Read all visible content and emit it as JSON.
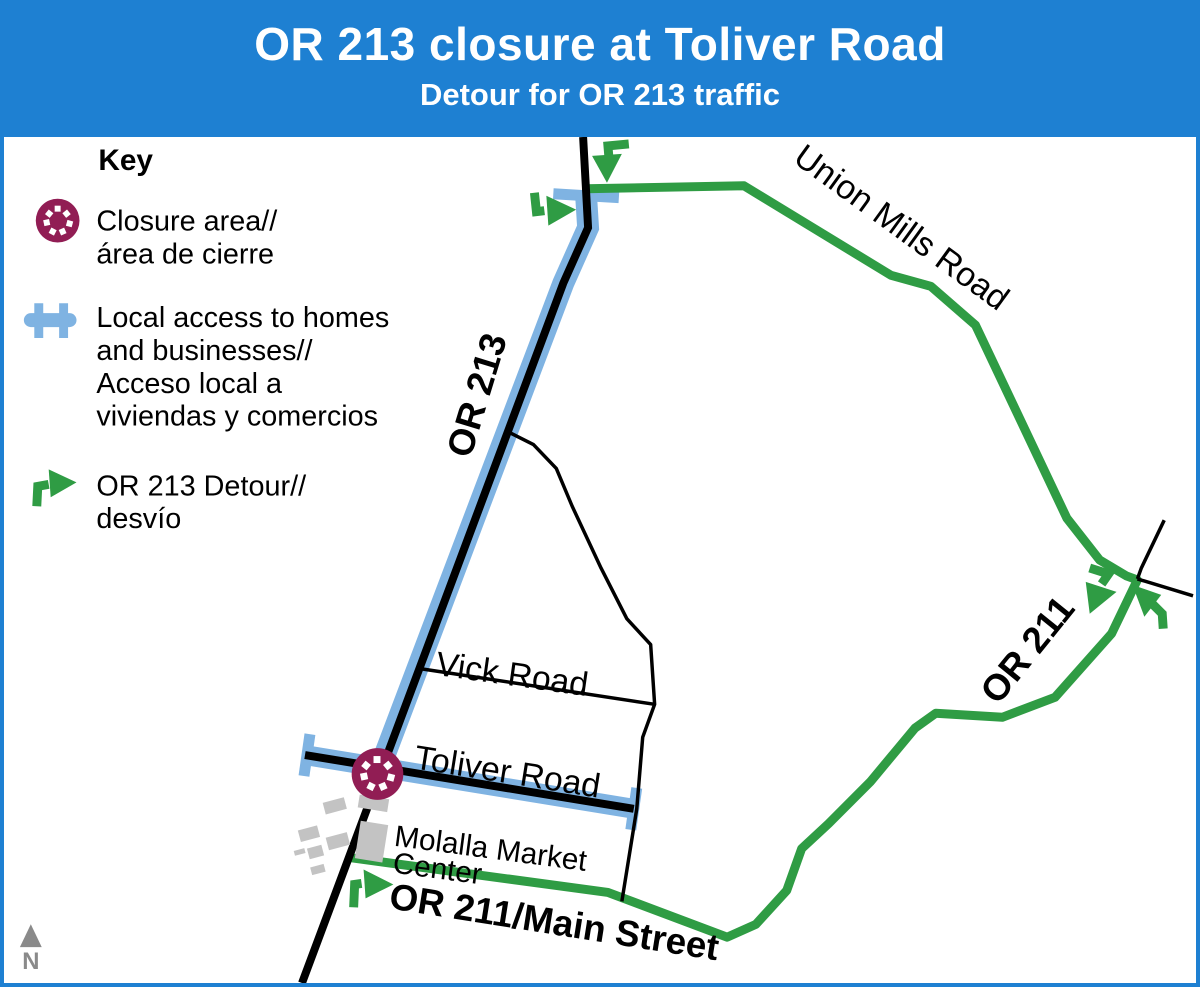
{
  "header": {
    "title": "OR 213 closure at Toliver Road",
    "subtitle": "Detour for OR 213 traffic"
  },
  "key": {
    "title": "Key",
    "closure": {
      "icon": "closure-area-icon",
      "line1": "Closure area//",
      "line2": "área de cierre"
    },
    "local_access": {
      "icon": "local-access-road-icon",
      "lines": [
        "Local access to homes",
        "and businesses//",
        "Acceso local a",
        "viviendas y comercios"
      ]
    },
    "detour": {
      "icon": "detour-arrow-icon",
      "line1": "OR 213 Detour//",
      "line2": "desvío"
    }
  },
  "map": {
    "road_labels": {
      "or213": "OR 213",
      "or211": "OR 211",
      "union_mills": "Union Mills Road",
      "vick": "Vick Road",
      "toliver": "Toliver Road",
      "or211_main": "OR 211/Main Street"
    },
    "places": {
      "molalla_line1": "Molalla Market",
      "molalla_line2": "Center"
    },
    "north_label": "N"
  },
  "colors": {
    "banner_blue": "#1e80d2",
    "detour_green": "#2f9c44",
    "local_access_blue": "#7fb3e2",
    "closure_maroon": "#911d54",
    "building_gray": "#c3c3c3",
    "north_gray": "#8a8a8a"
  }
}
